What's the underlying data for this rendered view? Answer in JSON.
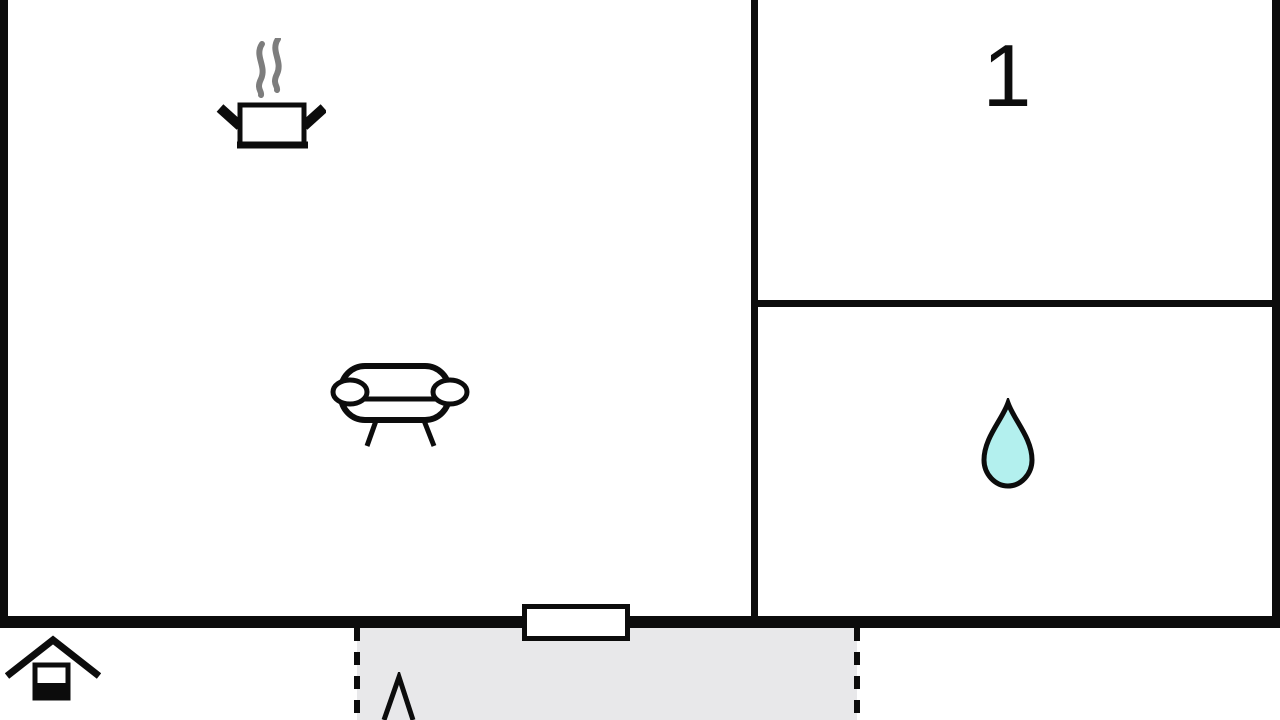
{
  "floorplan": {
    "room_number_label": "1",
    "colors": {
      "wall": "#0c0c0c",
      "background": "#ffffff",
      "terrace_fill": "#e8e8ea",
      "drop_fill": "#b3f0ee",
      "steam_gray": "#7d7d7d"
    },
    "icons": [
      {
        "name": "cooking-pot-icon"
      },
      {
        "name": "sofa-icon"
      },
      {
        "name": "water-drop-icon"
      },
      {
        "name": "house-icon"
      },
      {
        "name": "tree-icon"
      }
    ]
  }
}
